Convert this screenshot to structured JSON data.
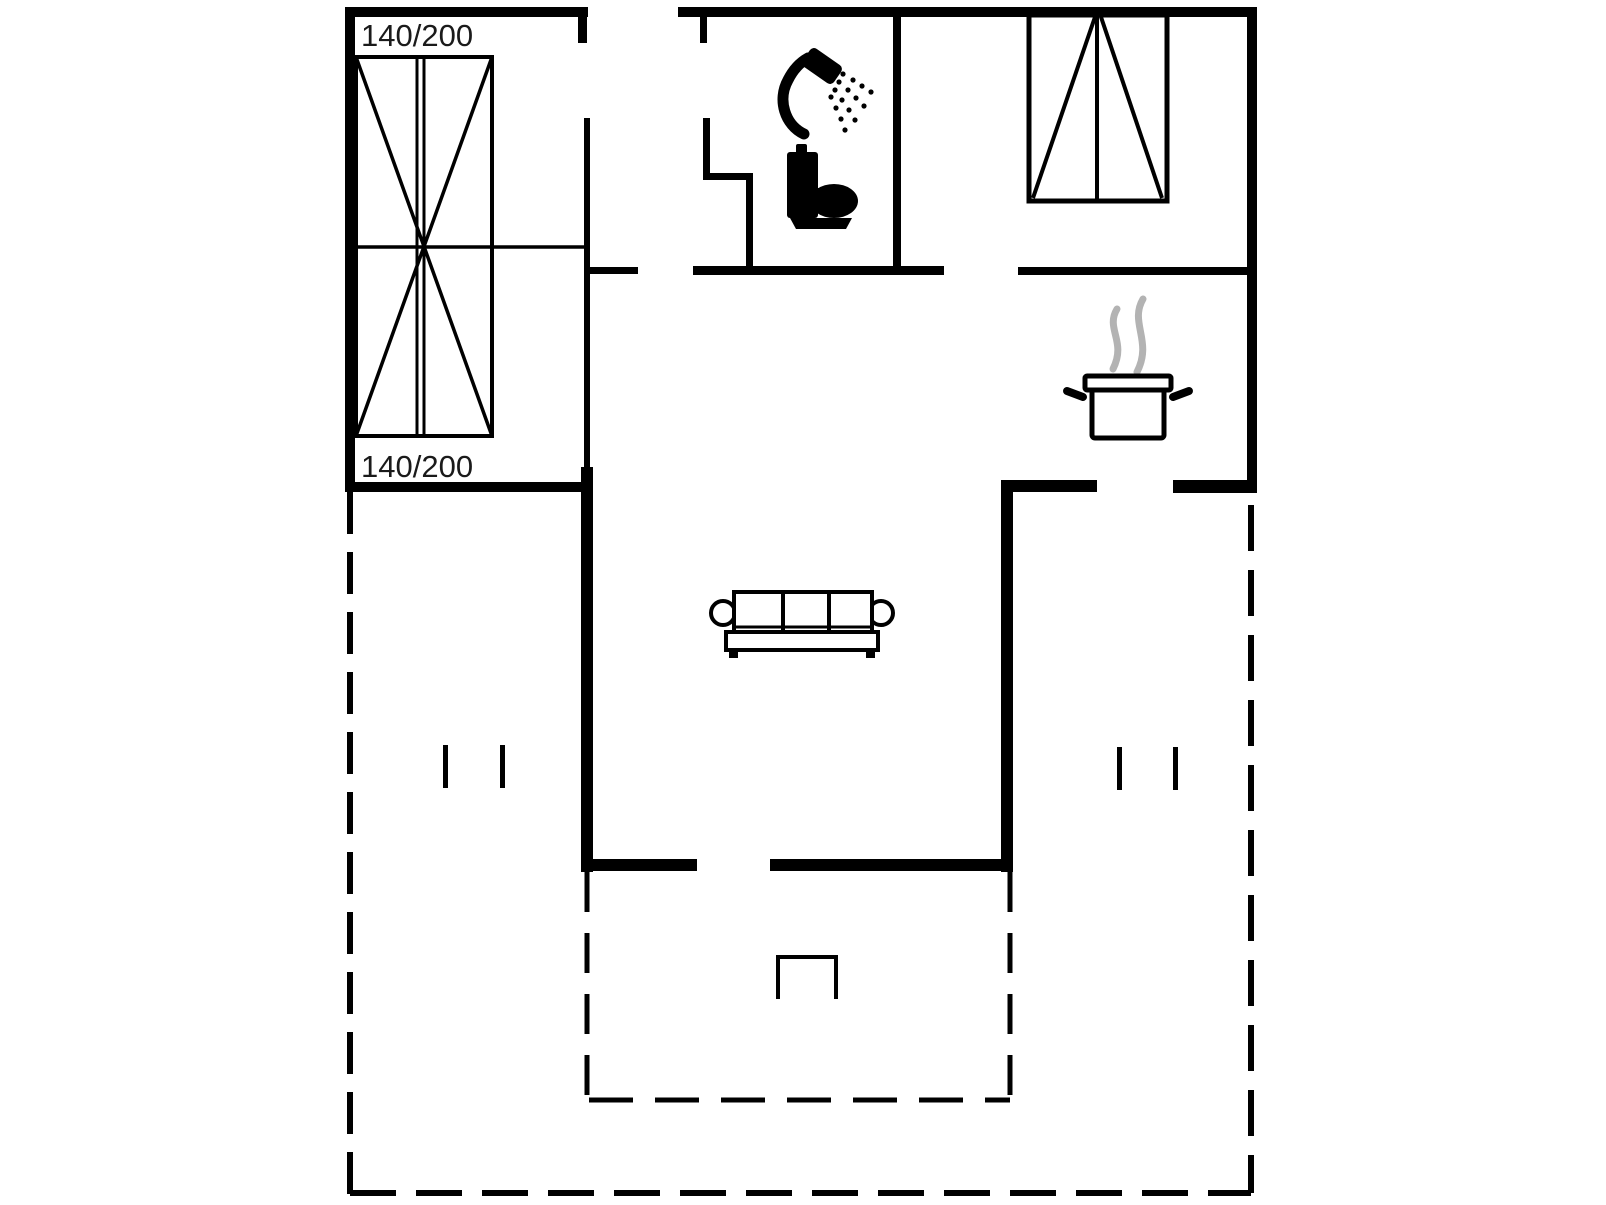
{
  "floor_plan": {
    "title": "holiday-home-floor-plan",
    "colors": {
      "wall": "#000000",
      "line": "#000000",
      "text": "#1a1a1a",
      "steam": "#b3b3b3",
      "background": "#ffffff"
    },
    "bedroom": {
      "bed_symbol": "double-bed-icon",
      "size_label_top": "140/200",
      "size_label_bottom": "140/200"
    },
    "bathroom": {
      "symbols": [
        "shower-icon",
        "toilet-icon"
      ]
    },
    "bedroom2": {
      "symbols": [
        "wardrobe-icon"
      ]
    },
    "kitchen": {
      "symbols": [
        "cooking-pot-icon",
        "steam-icon"
      ]
    },
    "living_room": {
      "symbols": [
        "sofa-icon"
      ]
    },
    "terrace": {
      "symbols": [
        "grill-icon"
      ],
      "boundary_style": "dashed"
    }
  }
}
